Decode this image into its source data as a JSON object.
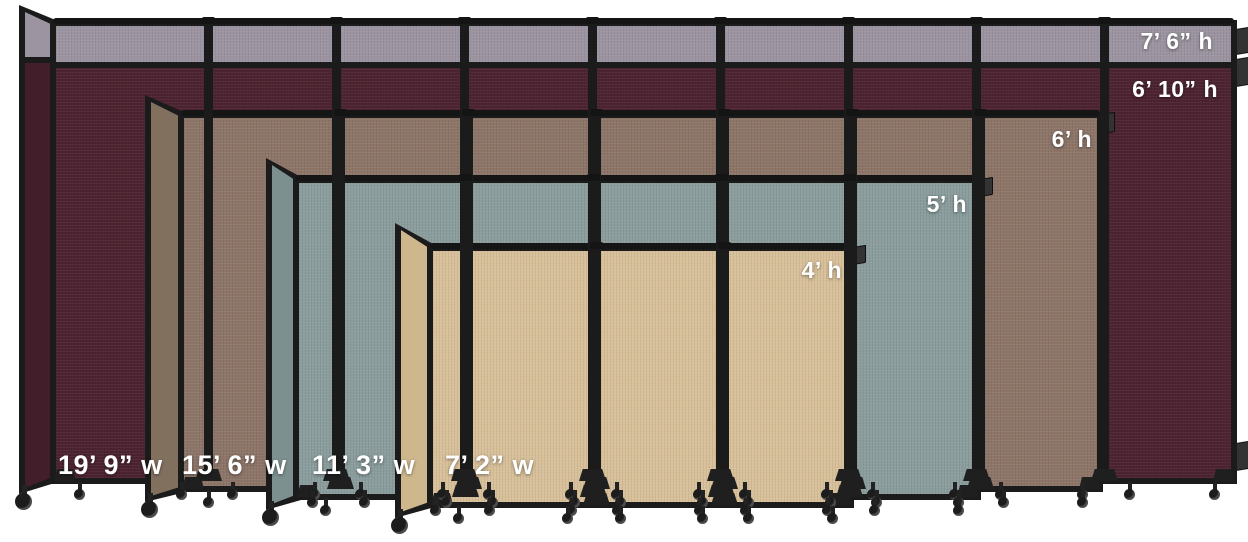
{
  "scene": {
    "description": "Portable room divider size comparison",
    "background": "#ffffff",
    "frame_color": "#1b1b1b",
    "label_color": "#ffffff"
  },
  "dividers": [
    {
      "id": "burgundy",
      "color": "#4c2330",
      "wing_color": "#411e2a",
      "topper_color": "#9c95a1",
      "labels": {
        "height_top": "7’ 6” h",
        "height": "6’ 10” h",
        "width": "19’ 9” w"
      }
    },
    {
      "id": "brown",
      "color": "#8d7568",
      "wing_color": "#82705f",
      "labels": {
        "height": "6’ h",
        "width": "15’ 6” w"
      }
    },
    {
      "id": "blue-gray",
      "color": "#8b9d9d",
      "wing_color": "#7c908f",
      "labels": {
        "height": "5’ h",
        "width": "11’ 3” w"
      }
    },
    {
      "id": "beige",
      "color": "#d8c09a",
      "wing_color": "#cfb78d",
      "labels": {
        "height": "4’ h",
        "width": "7’ 2” w"
      }
    }
  ]
}
